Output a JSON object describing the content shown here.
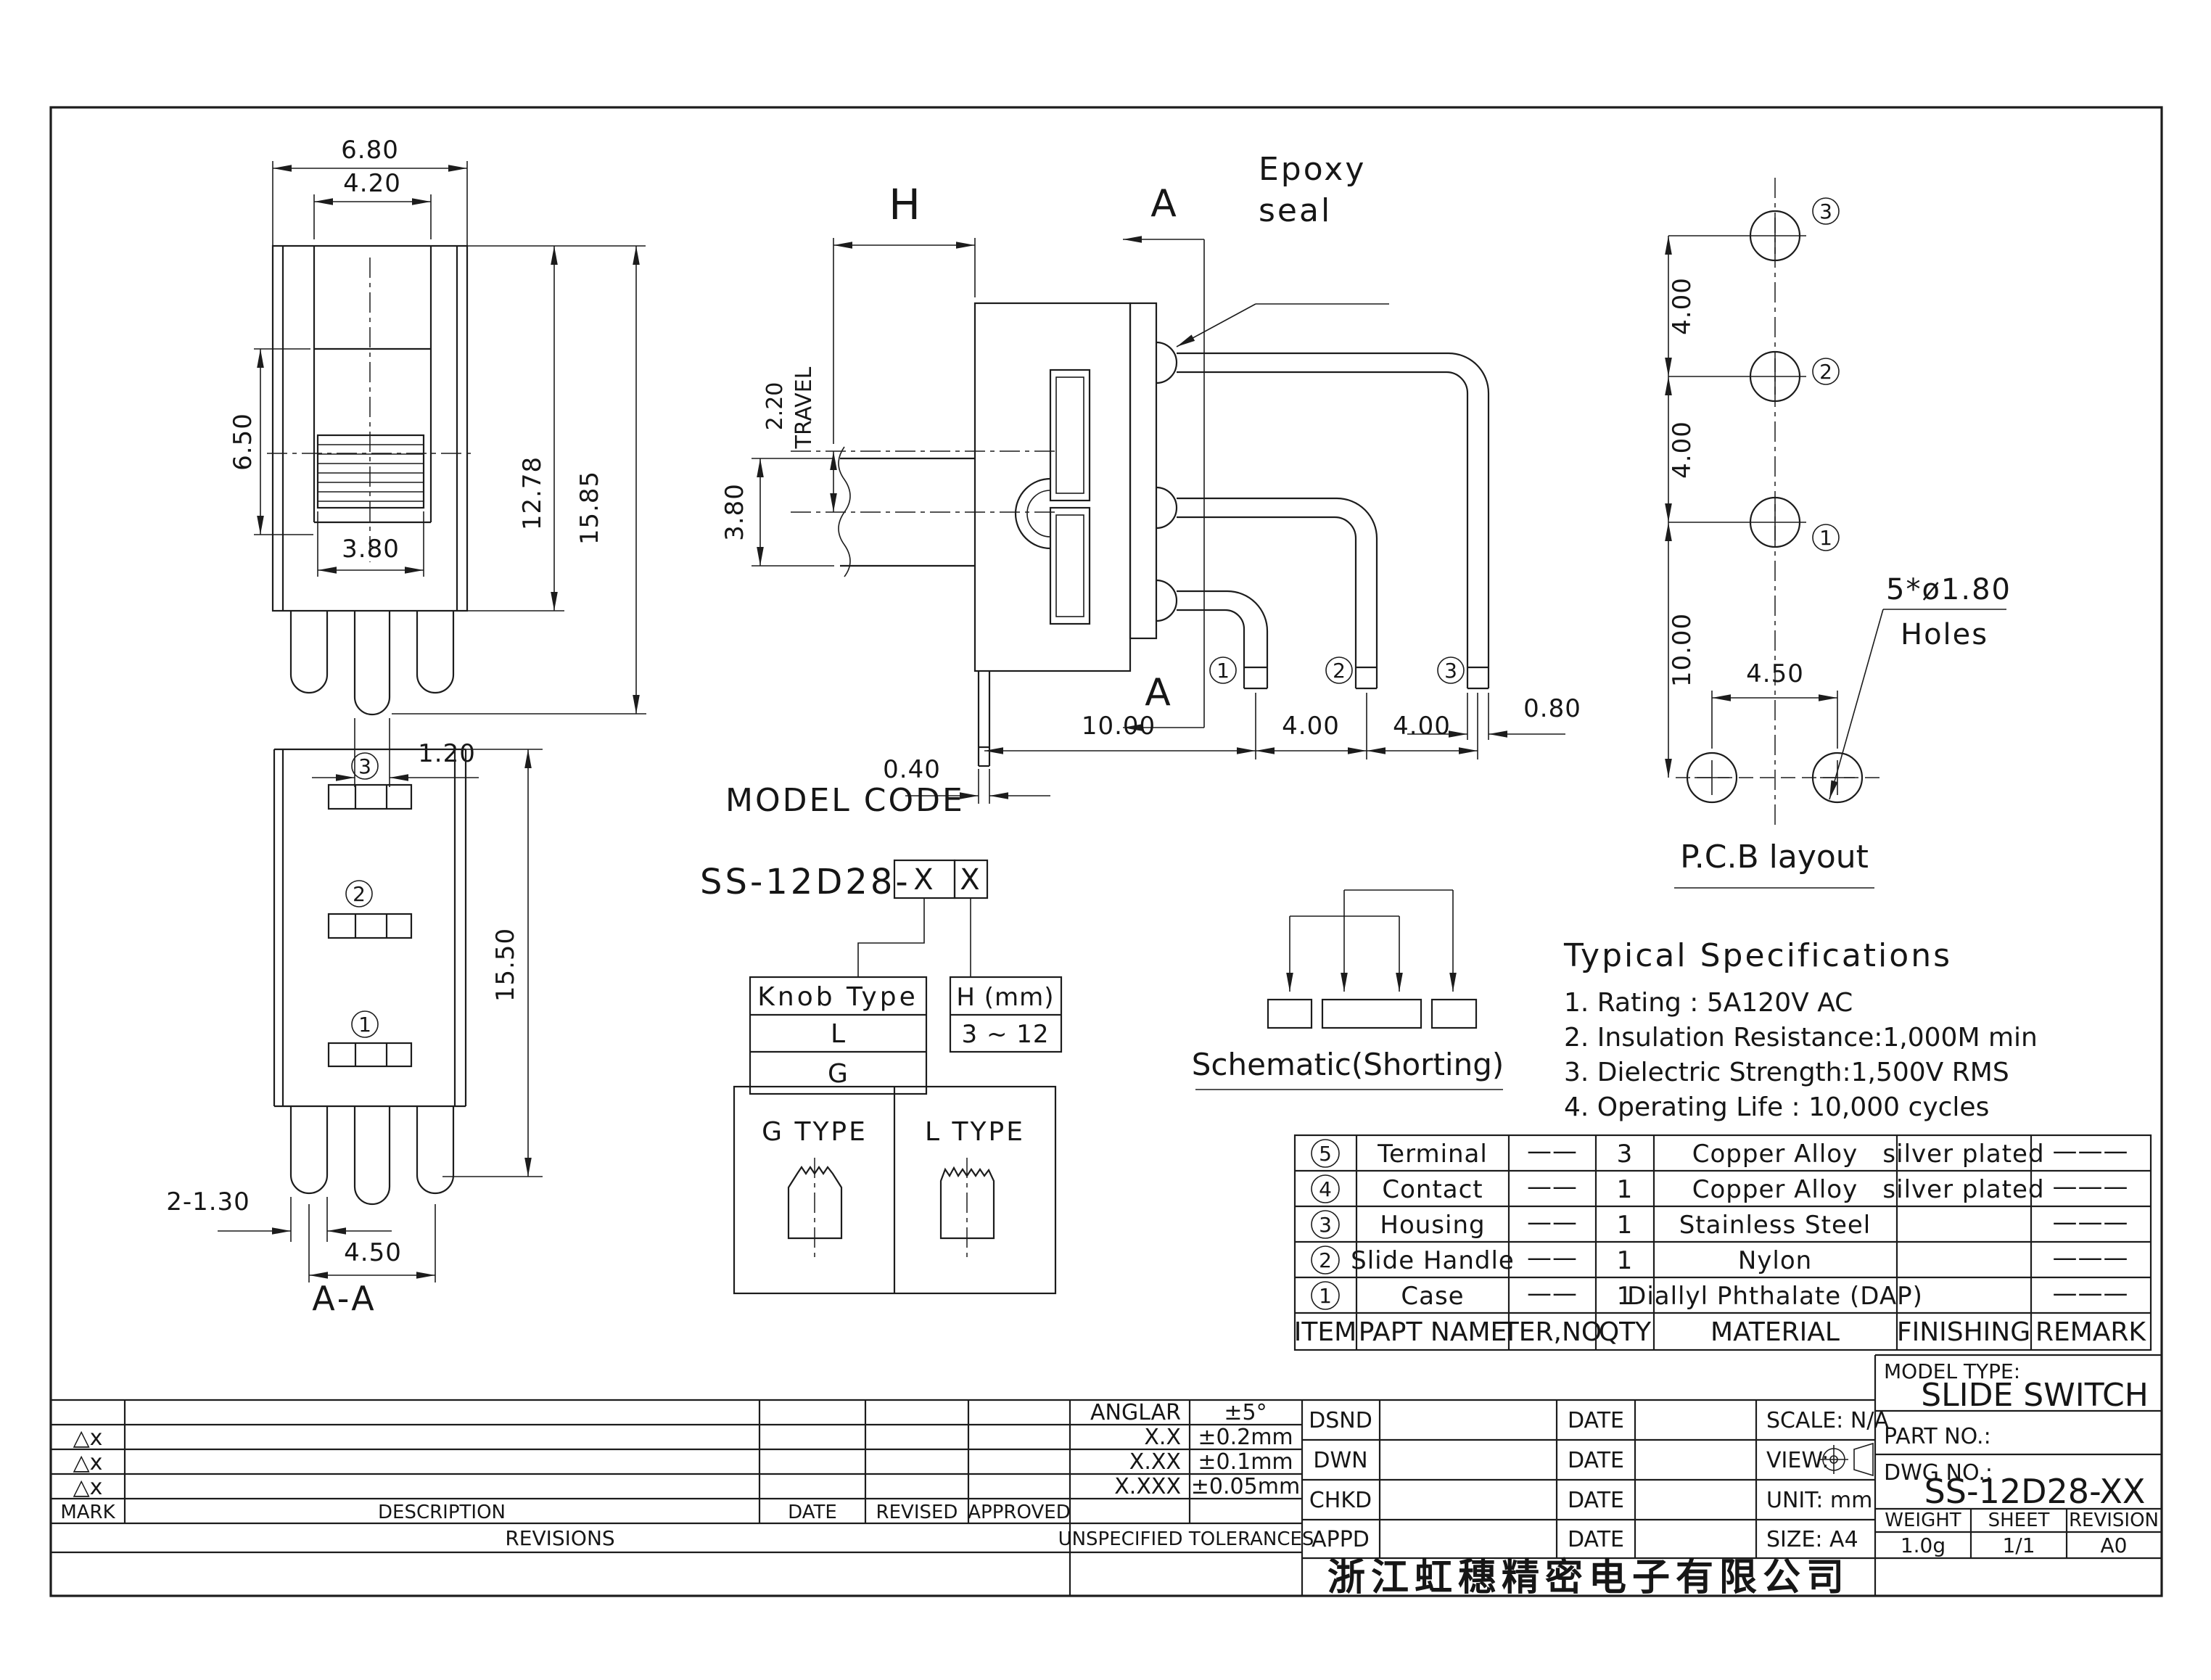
{
  "front": {
    "w_outer": "6.80",
    "w_window": "4.20",
    "h_knob": "6.50",
    "w_knob": "3.80",
    "h_body": "12.78",
    "h_total": "15.85",
    "w_pin": "1.20"
  },
  "side": {
    "h": "H",
    "travel": "2.20",
    "travel_word": "TRAVEL",
    "shaft": "3.80",
    "pin_w": "0.40",
    "off": "10.00",
    "p1": "4.00",
    "p2": "4.00",
    "tw": "0.80",
    "a_top": "A",
    "a_bottom": "A",
    "epoxy1": "Epoxy",
    "epoxy2": "seal",
    "n1": "1",
    "n2": "2",
    "n3": "3"
  },
  "pcb": {
    "p1": "4.00",
    "p2": "4.00",
    "off": "10.00",
    "bp": "4.50",
    "note1": "5*ø1.80",
    "note2": "Holes",
    "caption": "P.C.B layout",
    "n1": "1",
    "n2": "2",
    "n3": "3"
  },
  "sec": {
    "h": "15.50",
    "pin": "2-1.30",
    "pitch": "4.50",
    "caption": "A-A",
    "n1": "1",
    "n2": "2",
    "n3": "3"
  },
  "model": {
    "title": "MODEL CODE",
    "prefix": "SS-12D28-",
    "x1": "X",
    "x2": "X",
    "knob_header": "Knob Type",
    "knob_l": "L",
    "knob_g": "G",
    "h_header": "H (mm)",
    "h_range": "3 ~ 12"
  },
  "types": {
    "g": "G TYPE",
    "l": "L TYPE"
  },
  "schematic": {
    "caption": "Schematic(Shorting)"
  },
  "specs": {
    "title": "Typical Specifications",
    "items": [
      "1.  Rating : 5A120V AC",
      "2.  Insulation Resistance:1,000M min",
      "3.  Dielectric Strength:1,500V RMS",
      "4.  Operating Life : 10,000 cycles"
    ]
  },
  "bom": {
    "headers": [
      "ITEM",
      "PAPT NAME",
      "TER,NO",
      "QTY",
      "MATERIAL",
      "FINISHING",
      "REMARK"
    ],
    "rows": [
      {
        "item": "5",
        "name": "Terminal",
        "ter": "——",
        "qty": "3",
        "material": "Copper Alloy",
        "finishing": "silver plated",
        "remark": "———"
      },
      {
        "item": "4",
        "name": "Contact",
        "ter": "——",
        "qty": "1",
        "material": "Copper Alloy",
        "finishing": "silver plated",
        "remark": "———"
      },
      {
        "item": "3",
        "name": "Housing",
        "ter": "——",
        "qty": "1",
        "material": "Stainless Steel",
        "finishing": "",
        "remark": "———"
      },
      {
        "item": "2",
        "name": "Slide Handle",
        "ter": "——",
        "qty": "1",
        "material": "Nylon",
        "finishing": "",
        "remark": "———"
      },
      {
        "item": "1",
        "name": "Case",
        "ter": "——",
        "qty": "1",
        "material": "Diallyl Phthalate (DAP)",
        "finishing": "",
        "remark": "———"
      }
    ]
  },
  "rev": {
    "marks": [
      "△x",
      "△x",
      "△x"
    ],
    "mark_header": "MARK",
    "description_header": "DESCRIPTION",
    "date_header": "DATE",
    "revised_header": "REVISED",
    "approved_header": "APPROVED",
    "caption": "REVISIONS"
  },
  "tol": {
    "caption": "UNSPECIFIED TOLERANCES",
    "rows": [
      {
        "label": "ANGLAR",
        "value": "±5°"
      },
      {
        "label": "X.X",
        "value": "±0.2mm"
      },
      {
        "label": "X.XX",
        "value": "±0.1mm"
      },
      {
        "label": "X.XXX",
        "value": "±0.05mm"
      }
    ]
  },
  "appr": {
    "roles": [
      "DSND",
      "DWN",
      "CHKD",
      "APPD"
    ],
    "date_label": "DATE",
    "scale": "SCALE: N/A",
    "view_label": "VIEW:",
    "unit": "UNIT: mm",
    "size": "SIZE: A4",
    "company": "浙江虹穗精密电子有限公司"
  },
  "tb": {
    "model_type_label": "MODEL TYPE:",
    "model_type": "SLIDE SWITCH",
    "part_no_label": "PART NO.:",
    "dwg_no_label": "DWG NO.:",
    "dwg_no": "SS-12D28-XX",
    "weight_label": "WEIGHT",
    "weight": "1.0g",
    "sheet_label": "SHEET",
    "sheet": "1/1",
    "revision_label": "REVISION",
    "revision": "A0"
  }
}
